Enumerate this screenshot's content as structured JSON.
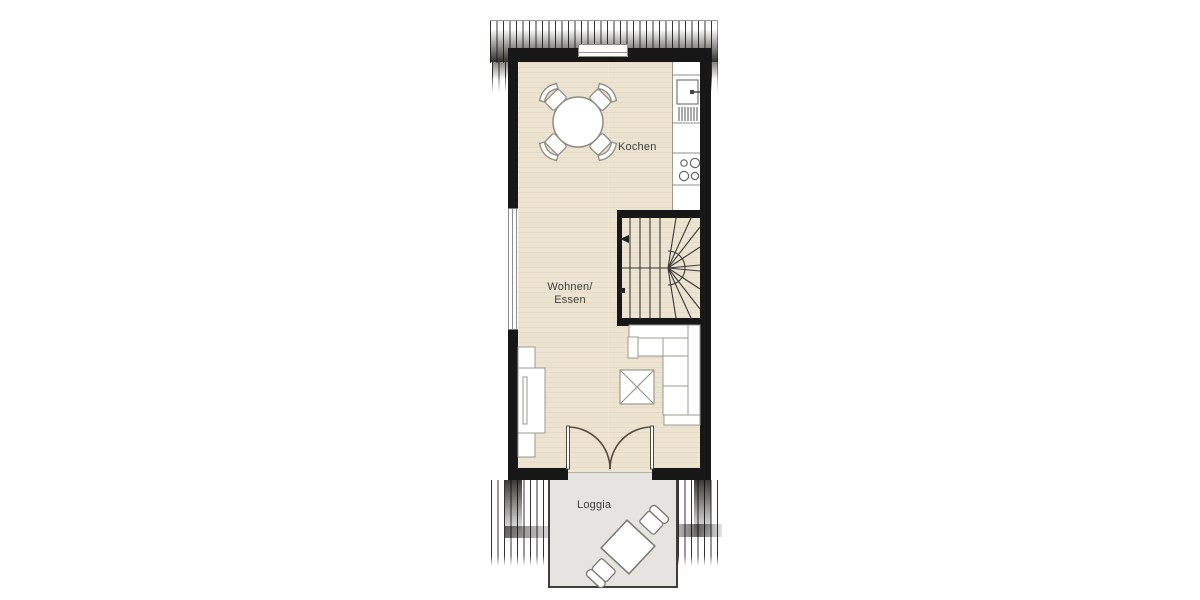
{
  "plan": {
    "type": "floor-plan",
    "rooms": {
      "kitchen": {
        "label": "Kochen"
      },
      "living": {
        "label_line1": "Wohnen/",
        "label_line2": "Essen"
      },
      "loggia": {
        "label": "Loggia"
      }
    },
    "furniture_icons": [
      "dining-table-icon",
      "dining-chair-icon",
      "kitchen-sink-icon",
      "kitchen-tap-icon",
      "dish-drainer-icon",
      "stove-burners-icon",
      "staircase-icon",
      "stair-direction-arrow-icon",
      "corner-sofa-icon",
      "coffee-table-icon",
      "sideboard-icon",
      "french-double-door-icon",
      "loggia-table-icon",
      "loggia-chair-icon",
      "window-icon",
      "roof-hatching"
    ],
    "colors": {
      "wall": "#171717",
      "interior_floor": "#ece3d0",
      "loggia_floor": "#e5e4e0",
      "furniture_stroke": "#8c8c82",
      "stair_stroke": "#3a3a3a",
      "door_stroke": "#55493c",
      "label_text": "#3f3f3f"
    }
  }
}
